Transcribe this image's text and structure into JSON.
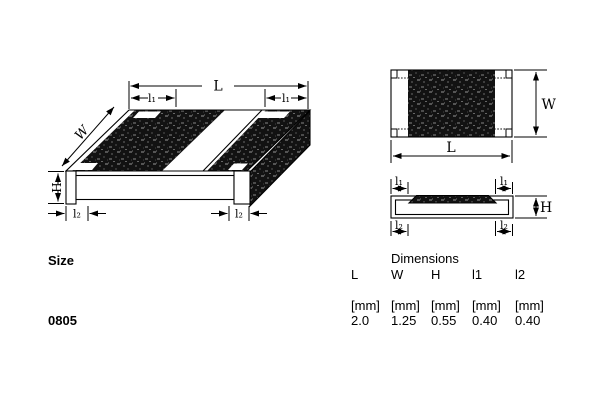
{
  "figure": {
    "description": "Chip resistor package outline drawing: isometric view, top view and side view with dimension callouts",
    "labels": {
      "L": "L",
      "W": "W",
      "H": "H",
      "l1": "l₁",
      "l2": "l₂"
    }
  },
  "table": {
    "size_header": "Size",
    "dimensions_header": "Dimensions",
    "size_value": "0805",
    "columns": [
      {
        "name": "L",
        "unit": "[mm]",
        "value": "2.0"
      },
      {
        "name": "W",
        "unit": "[mm]",
        "value": "1.25"
      },
      {
        "name": "H",
        "unit": "[mm]",
        "value": "0.55"
      },
      {
        "name": "l1",
        "unit": "[mm]",
        "value": "0.40"
      },
      {
        "name": "l2",
        "unit": "[mm]",
        "value": "0.40"
      }
    ]
  },
  "colors": {
    "background": "#ffffff",
    "ink": "#000000",
    "resistor_body_dark": "#121212",
    "speckle_light": "#555555"
  }
}
